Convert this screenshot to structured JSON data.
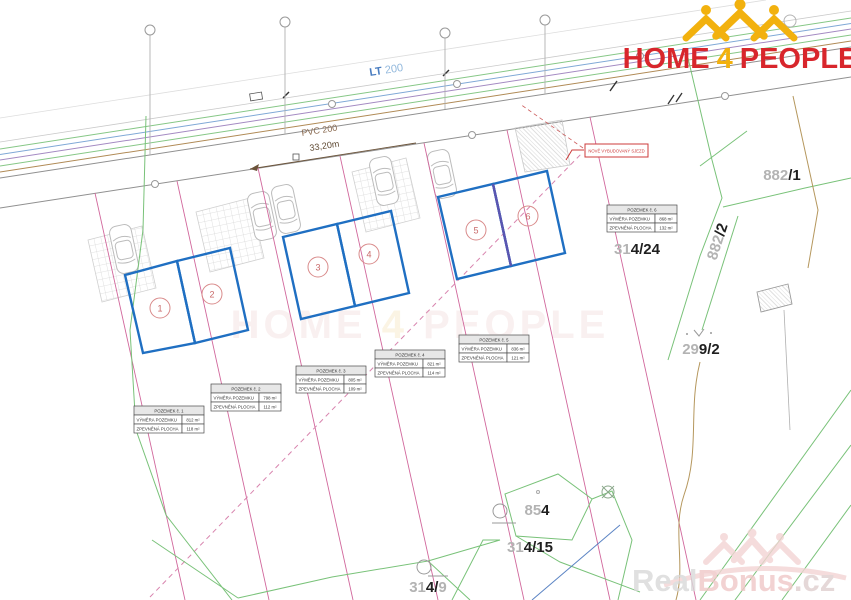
{
  "branding": {
    "home4people": {
      "home": "HOME",
      "four": "4",
      "people": "PEOPLE"
    },
    "realbonus": {
      "real": "Real",
      "bonus": "Bonus",
      "cz": ".cz"
    },
    "center_watermark": {
      "home": "HOME ",
      "four": "4",
      "people": " PEOPLE"
    }
  },
  "road": {
    "lt_label": "LT",
    "lt_size": "200",
    "pvc_label": "PVC 200",
    "dimension": "33,20m"
  },
  "callout": {
    "text": "NOVĚ VYBUDOVANÝ SJEZD"
  },
  "plots": {
    "numbers": [
      "1",
      "2",
      "3",
      "4",
      "5",
      "6"
    ]
  },
  "tables": [
    {
      "header": "POZEMEK č. 1",
      "rows": [
        [
          "VÝMĚRA POZEMKU",
          "812 m²"
        ],
        [
          "ZPEVNĚNÁ PLOCHA",
          "118 m²"
        ]
      ]
    },
    {
      "header": "POZEMEK č. 2",
      "rows": [
        [
          "VÝMĚRA POZEMKU",
          "798 m²"
        ],
        [
          "ZPEVNĚNÁ PLOCHA",
          "112 m²"
        ]
      ]
    },
    {
      "header": "POZEMEK č. 3",
      "rows": [
        [
          "VÝMĚRA POZEMKU",
          "805 m²"
        ],
        [
          "ZPEVNĚNÁ PLOCHA",
          "109 m²"
        ]
      ]
    },
    {
      "header": "POZEMEK č. 4",
      "rows": [
        [
          "VÝMĚRA POZEMKU",
          "821 m²"
        ],
        [
          "ZPEVNĚNÁ PLOCHA",
          "114 m²"
        ]
      ]
    },
    {
      "header": "POZEMEK č. 5",
      "rows": [
        [
          "VÝMĚRA POZEMKU",
          "836 m²"
        ],
        [
          "ZPEVNĚNÁ PLOCHA",
          "121 m²"
        ]
      ]
    },
    {
      "header": "POZEMEK č. 6",
      "rows": [
        [
          "VÝMĚRA POZEMKU",
          "868 m²"
        ],
        [
          "ZPEVNĚNÁ PLOCHA",
          "132 m²"
        ]
      ]
    }
  ],
  "parcels": {
    "p882_1": {
      "gray": "882",
      "bold": "/1"
    },
    "p882_2": {
      "gray": "882",
      "bold": "/2"
    },
    "p314_24": {
      "gray": "31",
      "bold": "4/24"
    },
    "p299_2": {
      "gray": "29",
      "bold": "9/2"
    },
    "p854": {
      "gray": "85",
      "bold": "4"
    },
    "p314_15": {
      "gray": "31",
      "bold": "4/15"
    },
    "p314_9": {
      "gray": "31",
      "bold": "4/",
      "gray2": "9"
    }
  },
  "map_symbols": [
    "manhole-circle",
    "survey-station",
    "well-symbol",
    "crossed-circle",
    "scrub-symbol",
    "paving-hatch",
    "car-top-view"
  ],
  "colors": {
    "plot_blue": "#1f6fc2",
    "divider_purple": "#5b55b0",
    "pink_boundary": "#d1679c",
    "green_boundary": "#79c279",
    "brand_red": "#d8262c",
    "brand_yellow": "#f2b10e",
    "watermark_pink": "#f0c8c8",
    "callout_red": "#cc3b3b"
  }
}
